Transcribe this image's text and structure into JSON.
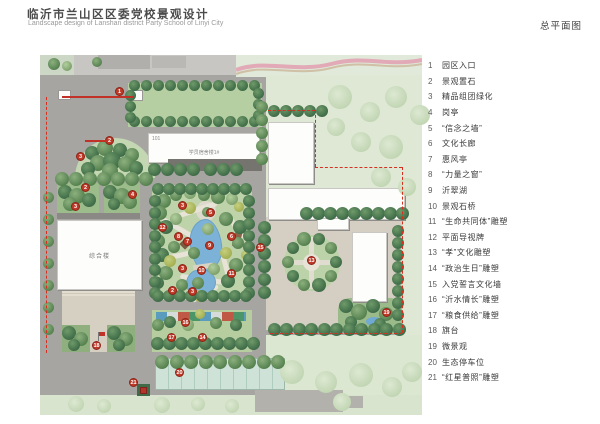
{
  "header": {
    "title_zh": "临沂市兰山区区委党校景观设计",
    "title_en": "Landscape design of Lanshan district Party School of Linyi City",
    "plan_type": "总平面图"
  },
  "legend": {
    "items": [
      {
        "no": "1",
        "label": "园区入口"
      },
      {
        "no": "2",
        "label": "景观置石"
      },
      {
        "no": "3",
        "label": "精品组团绿化"
      },
      {
        "no": "4",
        "label": "岗亭"
      },
      {
        "no": "5",
        "label": "“信念之墙”"
      },
      {
        "no": "6",
        "label": "文化长廊"
      },
      {
        "no": "7",
        "label": "惠风亭"
      },
      {
        "no": "8",
        "label": "“力量之窗”"
      },
      {
        "no": "9",
        "label": "沂翠湖"
      },
      {
        "no": "10",
        "label": "景观石桥"
      },
      {
        "no": "11",
        "label": "“生命共同体”雕塑"
      },
      {
        "no": "12",
        "label": "平面导视牌"
      },
      {
        "no": "13",
        "label": "“孝”文化雕塑"
      },
      {
        "no": "14",
        "label": "“政治生日”雕塑"
      },
      {
        "no": "15",
        "label": "入党誓言文化墙"
      },
      {
        "no": "16",
        "label": "“沂水情长”雕塑"
      },
      {
        "no": "17",
        "label": "“粮食供给”雕塑"
      },
      {
        "no": "18",
        "label": "旗台"
      },
      {
        "no": "19",
        "label": "微景观"
      },
      {
        "no": "20",
        "label": "生态停车位"
      },
      {
        "no": "21",
        "label": "“红星普照”雕塑"
      }
    ]
  },
  "plan": {
    "buildings": [
      {
        "label": "综合楼"
      },
      {
        "code": "101",
        "label": "学员宿舍楼1#"
      }
    ],
    "markers": [
      {
        "no": "1",
        "x": 80,
        "y": 37
      },
      {
        "no": "2",
        "x": 70,
        "y": 86
      },
      {
        "no": "3",
        "x": 41,
        "y": 102
      },
      {
        "no": "2",
        "x": 46,
        "y": 133
      },
      {
        "no": "3",
        "x": 36,
        "y": 152
      },
      {
        "no": "4",
        "x": 93,
        "y": 140
      },
      {
        "no": "3",
        "x": 143,
        "y": 151
      },
      {
        "no": "5",
        "x": 171,
        "y": 158
      },
      {
        "no": "12",
        "x": 123,
        "y": 173
      },
      {
        "no": "8",
        "x": 139,
        "y": 182
      },
      {
        "no": "7",
        "x": 148,
        "y": 187
      },
      {
        "no": "6",
        "x": 192,
        "y": 182
      },
      {
        "no": "9",
        "x": 170,
        "y": 191
      },
      {
        "no": "3",
        "x": 143,
        "y": 214
      },
      {
        "no": "10",
        "x": 162,
        "y": 216
      },
      {
        "no": "11",
        "x": 192,
        "y": 219
      },
      {
        "no": "2",
        "x": 133,
        "y": 236
      },
      {
        "no": "3",
        "x": 153,
        "y": 237
      },
      {
        "no": "15",
        "x": 221,
        "y": 193
      },
      {
        "no": "13",
        "x": 272,
        "y": 206
      },
      {
        "no": "19",
        "x": 347,
        "y": 258
      },
      {
        "no": "16",
        "x": 146,
        "y": 268
      },
      {
        "no": "17",
        "x": 132,
        "y": 283
      },
      {
        "no": "14",
        "x": 163,
        "y": 283
      },
      {
        "no": "18",
        "x": 57,
        "y": 291
      },
      {
        "no": "20",
        "x": 140,
        "y": 318
      },
      {
        "no": "21",
        "x": 94,
        "y": 328
      }
    ]
  },
  "colors": {
    "marker_red": "#bf3a28",
    "boundary_red": "#d42f1f",
    "lake_blue": "#7db2d8",
    "road_gray": "#a7a5a1"
  }
}
